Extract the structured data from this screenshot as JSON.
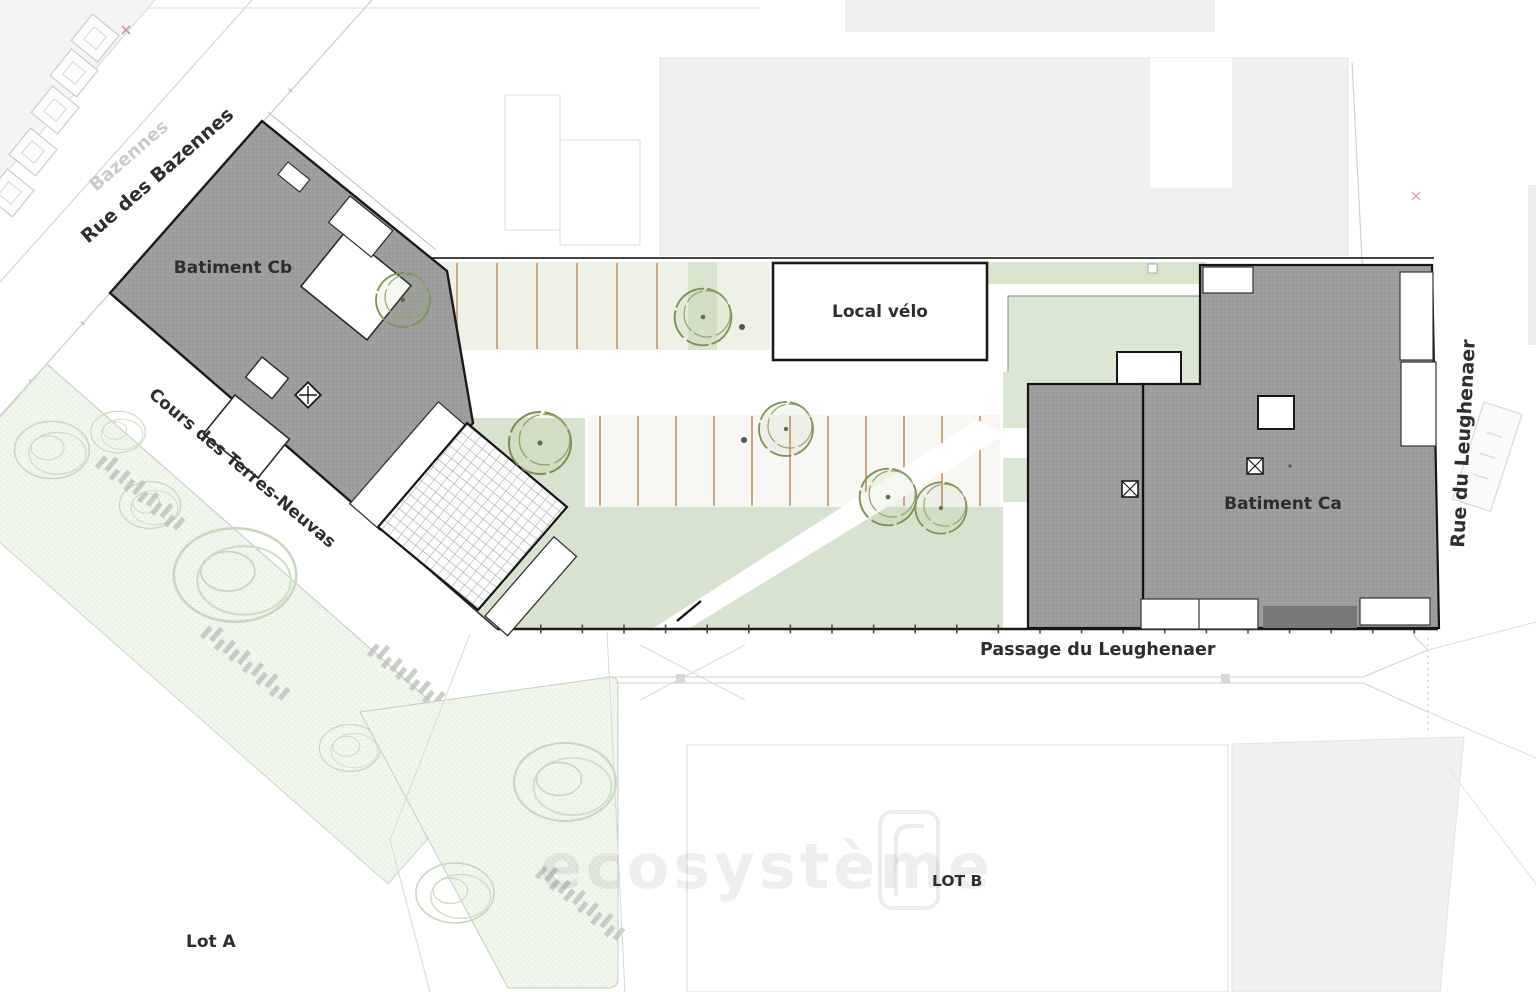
{
  "plan": {
    "labels": {
      "building_cb": "Batiment Cb",
      "building_ca": "Batiment Ca",
      "local_velo": "Local vélo",
      "lot_a": "Lot A",
      "lot_b": "LOT B"
    },
    "streets": {
      "bazennes": "Rue des Bazennes",
      "bazennes_faint": "Bazennes",
      "terres_neuvas": "Cours des Terres-Neuvas",
      "leughenaer": "Rue du Leughenaer",
      "passage": "Passage du Leughenaer"
    },
    "watermark": {
      "text": "ecosystème"
    },
    "colors": {
      "building_fill": "#9d9d9d",
      "outline": "#1a1a1a",
      "lawn": "#d8e3cf",
      "courtyard": "#dbe7d3",
      "parking_tint": "#edf1e6",
      "stall_divider": "#c79e72",
      "park_texture_bg": "#f1f6ed",
      "tree_stroke": "#7f9153",
      "background_parcel": "#f0f0f1"
    }
  }
}
